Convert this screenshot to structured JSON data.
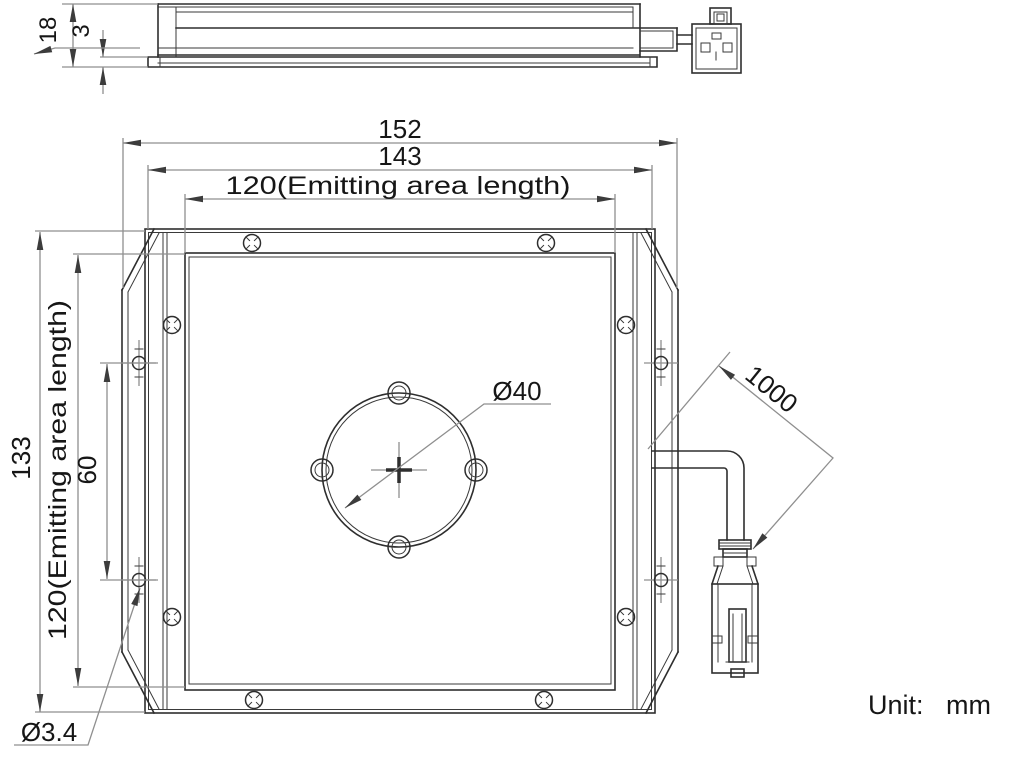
{
  "drawing": {
    "unit_label": "Unit:",
    "unit_value": "mm",
    "colors": {
      "object_line": "#2e2e2e",
      "dimension_line": "#8f8f8f",
      "text": "#161616",
      "background": "#ffffff"
    },
    "side_view": {
      "thickness": "18",
      "plate_thickness": "3"
    },
    "front_view": {
      "overall_width": "152",
      "frame_width": "143",
      "emitting_area_width": "120(Emitting area length)",
      "overall_height": "133",
      "emitting_area_height": "120(Emitting area length)",
      "mount_hole_spacing": "60",
      "center_hole_diameter": "Ø40",
      "mount_hole_diameter": "Ø3.4",
      "cable_length": "1000"
    }
  }
}
